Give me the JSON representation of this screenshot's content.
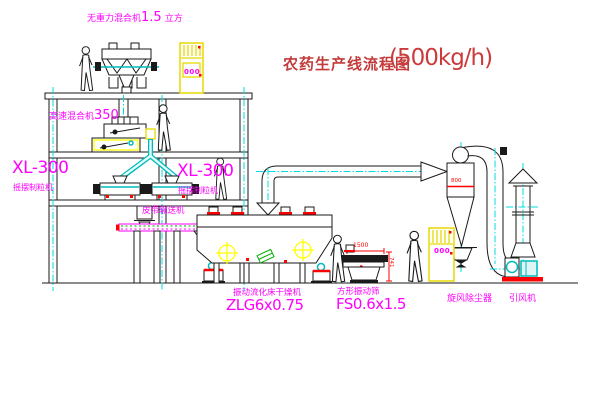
{
  "drawing": {
    "title": "农药生产线流程图",
    "title_capacity": "(500kg/h)"
  },
  "equipment": {
    "gravity_mixer": {
      "name": "无重力混合机",
      "size": "1.5",
      "unit": "立方"
    },
    "high_speed_mixer": {
      "name": "高速混合机",
      "size": "350"
    },
    "granulator_left": {
      "model": "XL-300",
      "name": "摇摆制粒机"
    },
    "granulator_right": {
      "model": "XL-300",
      "name": "摇摆制粒机"
    },
    "belt_conveyor": {
      "name": "皮带输送机"
    },
    "fluid_bed_dryer": {
      "name": "振动流化床干燥机",
      "model": "ZLG6x0.75"
    },
    "vibrating_screen": {
      "name": "方形振动筛",
      "model": "FS0.6x1.5"
    },
    "cyclone_dust_collector": {
      "name": "旋风除尘器"
    },
    "induced_draft_fan": {
      "name": "引风机"
    }
  },
  "dimensions": {
    "screen_length": "1500",
    "screen_height": "741",
    "cyclone_body": "800"
  },
  "cabinets": {
    "upper_display": "000",
    "lower_display": "000"
  },
  "colors": {
    "title_red": "#c43b3b",
    "label_magenta": "#ff00ff",
    "centerline_cyan": "#00dddd",
    "pipe_teal": "#00bbbb",
    "highlight_yellow": "#ffff00",
    "accent_red": "#ff0000",
    "accent_green": "#00aa00",
    "line_black": "#1a1a1a"
  }
}
